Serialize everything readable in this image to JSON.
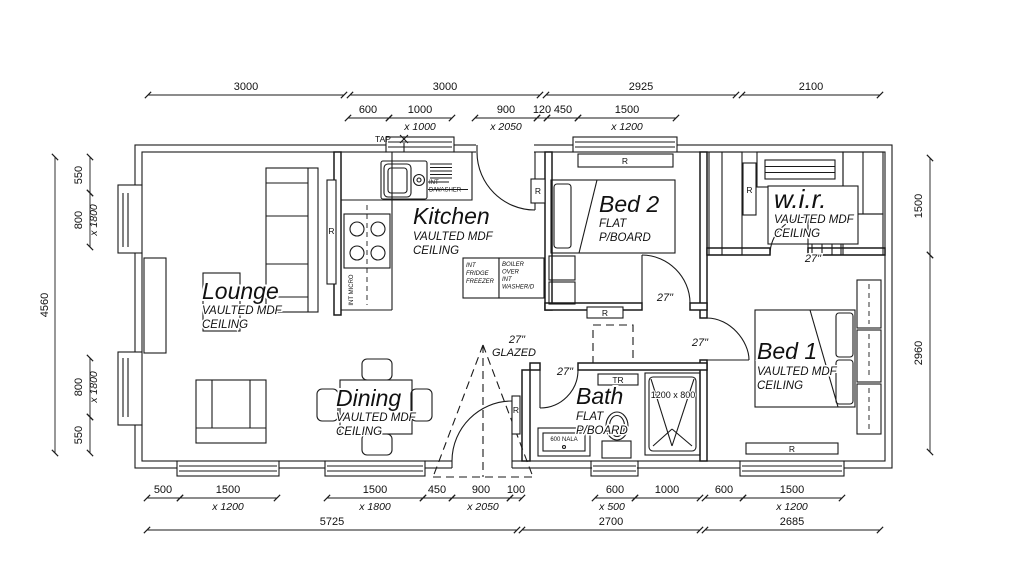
{
  "drawing": {
    "rooms": {
      "lounge": {
        "name": "Lounge",
        "sub1": "VAULTED MDF",
        "sub2": "CEILING"
      },
      "kitchen": {
        "name": "Kitchen",
        "sub1": "VAULTED MDF",
        "sub2": "CEILING"
      },
      "dining": {
        "name": "Dining",
        "sub1": "VAULTED MDF",
        "sub2": "CEILING"
      },
      "bath": {
        "name": "Bath",
        "sub1": "FLAT",
        "sub2": "P/BOARD"
      },
      "bed2": {
        "name": "Bed 2",
        "sub1": "FLAT",
        "sub2": "P/BOARD"
      },
      "wir": {
        "name": "w.i.r.",
        "sub1": "VAULTED MDF",
        "sub2": "CEILING"
      },
      "bed1": {
        "name": "Bed 1",
        "sub1": "VAULTED MDF",
        "sub2": "CEILING"
      }
    },
    "fixtures": {
      "tap": "TAP",
      "dw1": "INT",
      "dw2": "D/WASHER",
      "micro": "INT MICRO",
      "fridge1": "INT",
      "fridge2": "FRIDGE",
      "fridge3": "FREEZER",
      "boiler1": "BOILER",
      "boiler2": "OVER",
      "boiler3": "INT",
      "boiler4": "WASHER/D",
      "towel_rail": "TR",
      "shower_size": "1200 x 800",
      "vanity": "600 NALA",
      "radiator": "R",
      "door_width": "27\"",
      "glazed": "GLAZED"
    },
    "dims": {
      "top1": [
        "3000",
        "3000",
        "2925",
        "2100"
      ],
      "top2": [
        "600",
        "1000",
        "x 1000",
        "900",
        "x 2050",
        "120",
        "450",
        "1500",
        "x 1200"
      ],
      "left": [
        "4560",
        "550",
        "800",
        "x 1800",
        "800",
        "x 1800",
        "550"
      ],
      "right": [
        "1500",
        "2960"
      ],
      "bottom1": [
        "500",
        "1500",
        "x 1200",
        "1500",
        "x 1800",
        "450",
        "900",
        "x 2050",
        "100",
        "600",
        "x 500",
        "1000",
        "600",
        "1500",
        "x 1200"
      ],
      "bottom2": [
        "5725",
        "2700",
        "2685"
      ]
    },
    "colors": {
      "ink": "#1a1a1a",
      "paper": "#ffffff"
    }
  }
}
